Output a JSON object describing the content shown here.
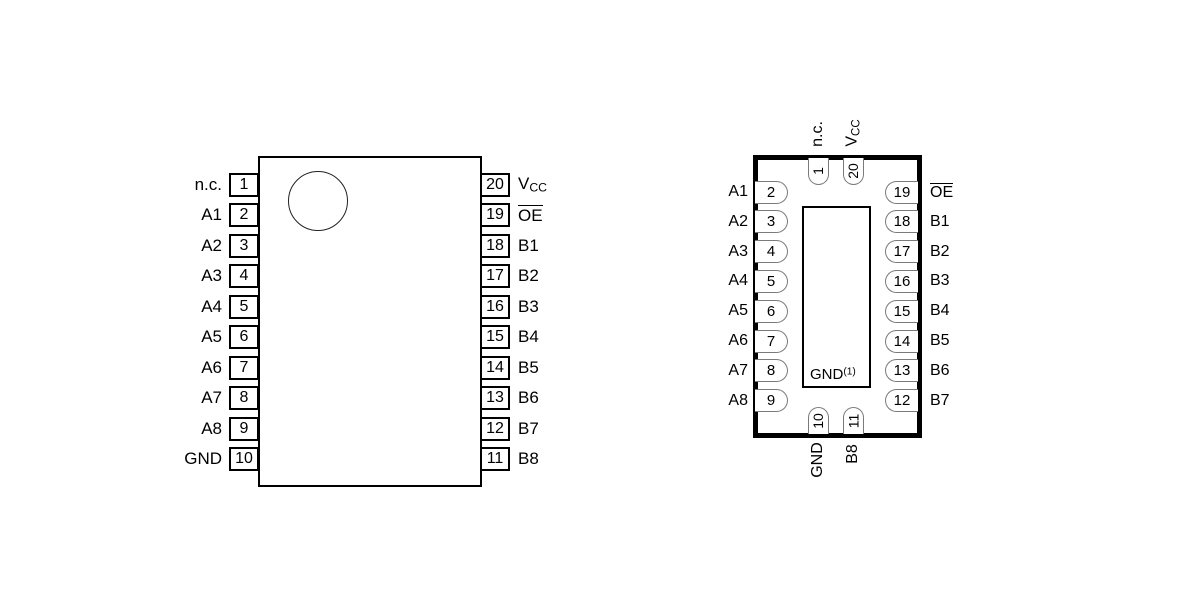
{
  "figure": {
    "description": "20-pin logic device pinout, two package views"
  },
  "colors": {
    "line": "#000000",
    "pin_outline": "#7a7a7a",
    "text": "#000000",
    "background": "#ffffff"
  },
  "dip": {
    "left_pins": [
      {
        "num": "1",
        "label": {
          "base": "n.c."
        }
      },
      {
        "num": "2",
        "label": {
          "base": "A1"
        }
      },
      {
        "num": "3",
        "label": {
          "base": "A2"
        }
      },
      {
        "num": "4",
        "label": {
          "base": "A3"
        }
      },
      {
        "num": "5",
        "label": {
          "base": "A4"
        }
      },
      {
        "num": "6",
        "label": {
          "base": "A5"
        }
      },
      {
        "num": "7",
        "label": {
          "base": "A6"
        }
      },
      {
        "num": "8",
        "label": {
          "base": "A7"
        }
      },
      {
        "num": "9",
        "label": {
          "base": "A8"
        }
      },
      {
        "num": "10",
        "label": {
          "base": "GND"
        }
      }
    ],
    "right_pins": [
      {
        "num": "20",
        "label": {
          "base": "V",
          "sub": "CC"
        }
      },
      {
        "num": "19",
        "label": {
          "base": "OE",
          "overline": true
        }
      },
      {
        "num": "18",
        "label": {
          "base": "B1"
        }
      },
      {
        "num": "17",
        "label": {
          "base": "B2"
        }
      },
      {
        "num": "16",
        "label": {
          "base": "B3"
        }
      },
      {
        "num": "15",
        "label": {
          "base": "B4"
        }
      },
      {
        "num": "14",
        "label": {
          "base": "B5"
        }
      },
      {
        "num": "13",
        "label": {
          "base": "B6"
        }
      },
      {
        "num": "12",
        "label": {
          "base": "B7"
        }
      },
      {
        "num": "11",
        "label": {
          "base": "B8"
        }
      }
    ]
  },
  "qfn": {
    "top_pins": [
      {
        "num": "1",
        "label": {
          "base": "n.c."
        }
      },
      {
        "num": "20",
        "label": {
          "base": "V",
          "sub": "CC"
        }
      }
    ],
    "left_pins": [
      {
        "num": "2",
        "label": {
          "base": "A1"
        }
      },
      {
        "num": "3",
        "label": {
          "base": "A2"
        }
      },
      {
        "num": "4",
        "label": {
          "base": "A3"
        }
      },
      {
        "num": "5",
        "label": {
          "base": "A4"
        }
      },
      {
        "num": "6",
        "label": {
          "base": "A5"
        }
      },
      {
        "num": "7",
        "label": {
          "base": "A6"
        }
      },
      {
        "num": "8",
        "label": {
          "base": "A7"
        }
      },
      {
        "num": "9",
        "label": {
          "base": "A8"
        }
      }
    ],
    "right_pins": [
      {
        "num": "19",
        "label": {
          "base": "OE",
          "overline": true
        }
      },
      {
        "num": "18",
        "label": {
          "base": "B1"
        }
      },
      {
        "num": "17",
        "label": {
          "base": "B2"
        }
      },
      {
        "num": "16",
        "label": {
          "base": "B3"
        }
      },
      {
        "num": "15",
        "label": {
          "base": "B4"
        }
      },
      {
        "num": "14",
        "label": {
          "base": "B5"
        }
      },
      {
        "num": "13",
        "label": {
          "base": "B6"
        }
      },
      {
        "num": "12",
        "label": {
          "base": "B7"
        }
      }
    ],
    "bottom_pins": [
      {
        "num": "10",
        "label": {
          "base": "GND"
        }
      },
      {
        "num": "11",
        "label": {
          "base": "B8"
        }
      }
    ],
    "pad_label": {
      "base": "GND",
      "sup": "(1)"
    }
  }
}
